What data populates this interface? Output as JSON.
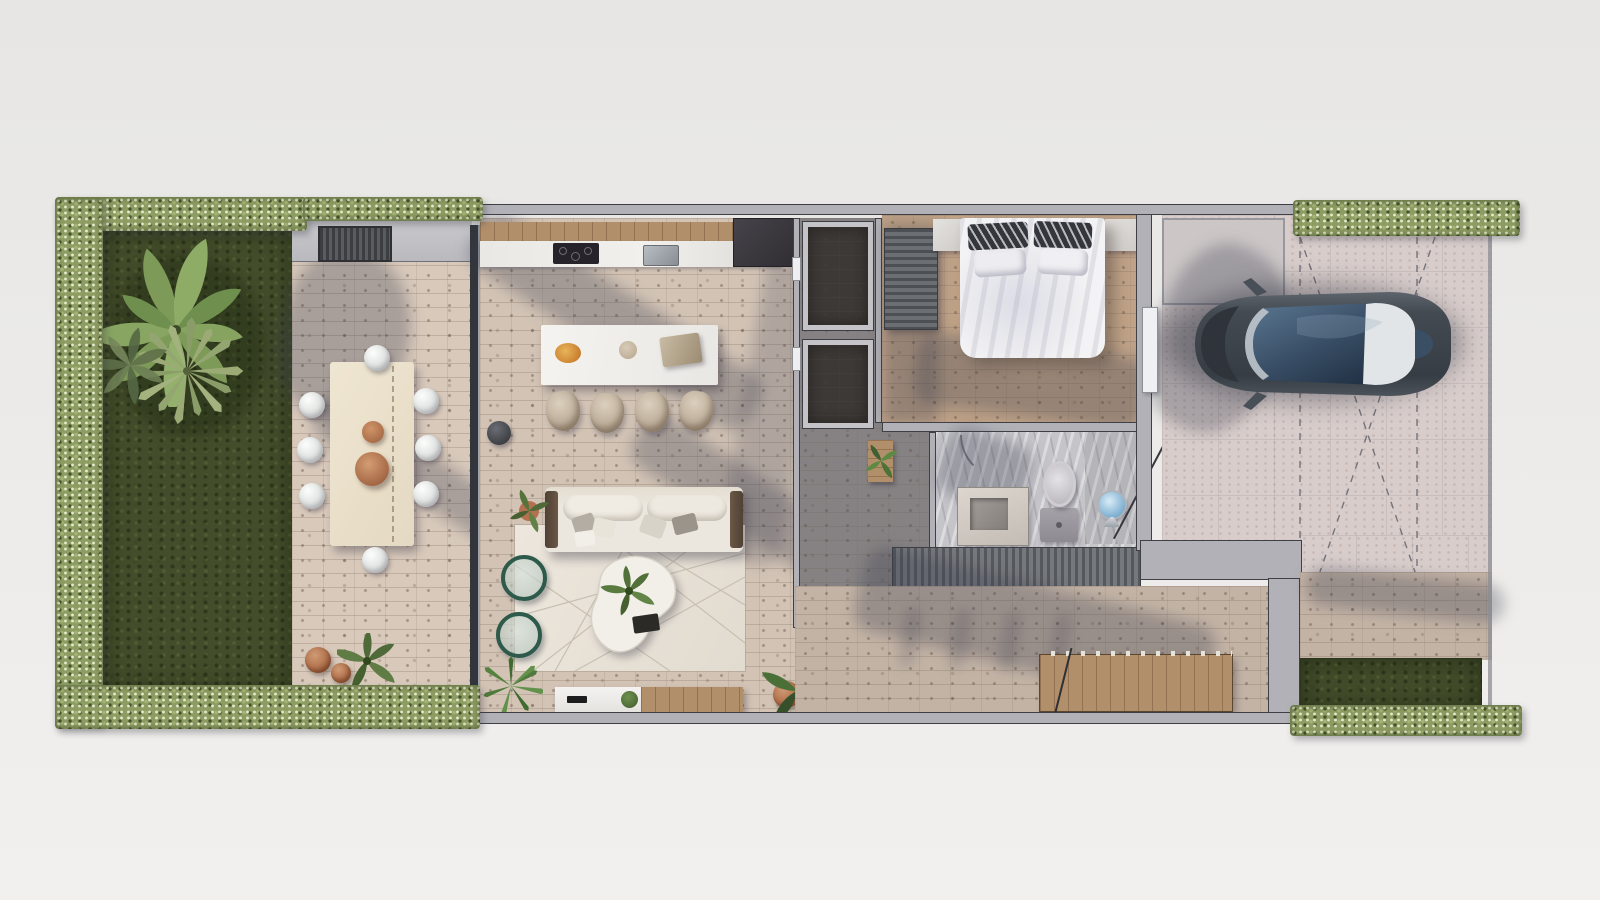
{
  "scene": {
    "title": "Top-down 3D rendering of a narrow-lot house floor plan",
    "view": "top-down aerial render",
    "background": "#ebeae8"
  },
  "palette": {
    "lawn_green": "#434d2b",
    "hedge_green": "#8d9c63",
    "brick_paving": "#d2c3b5",
    "bedroom_floor": "#bfa287",
    "concrete_drive": "#d8cdcb",
    "marble_bath": "#c5c4c9",
    "wood_deck": "#b28f6b",
    "wall_gray": "#b1b1b7",
    "car_body": "#3d444b",
    "car_glass": "#3d566e",
    "copper_tray": "#b87a57",
    "sofa_cream": "#ece7de",
    "shadow_tint": "rgba(56,58,76,0.30)"
  },
  "areas": {
    "garden": {
      "label": "garden with lawn, hedge border and palms"
    },
    "patio": {
      "label": "outdoor terrace with 8-seat dining table",
      "seats": 8,
      "trays": 2
    },
    "kitchen": {
      "label": "kitchen with cabinets, cooktop and sink"
    },
    "dining": {
      "label": "indoor dining table with 4 chairs",
      "seats": 4
    },
    "living": {
      "label": "living room with sofa, rug, coffee table and tv console"
    },
    "closets": {
      "label": "two dark utility closets",
      "count": 2
    },
    "hallway": {
      "label": "hallway with console plant"
    },
    "bedroom": {
      "label": "bedroom with double bed, nightstands and wardrobe"
    },
    "bathroom": {
      "label": "bathroom with vanity, toilet and shower"
    },
    "carport": {
      "label": "driveway carport with parked car and dashed parking marks"
    },
    "deck": {
      "label": "wood slat deck / stair screen"
    },
    "backyard": {
      "label": "rear grass strip with hedge"
    }
  }
}
